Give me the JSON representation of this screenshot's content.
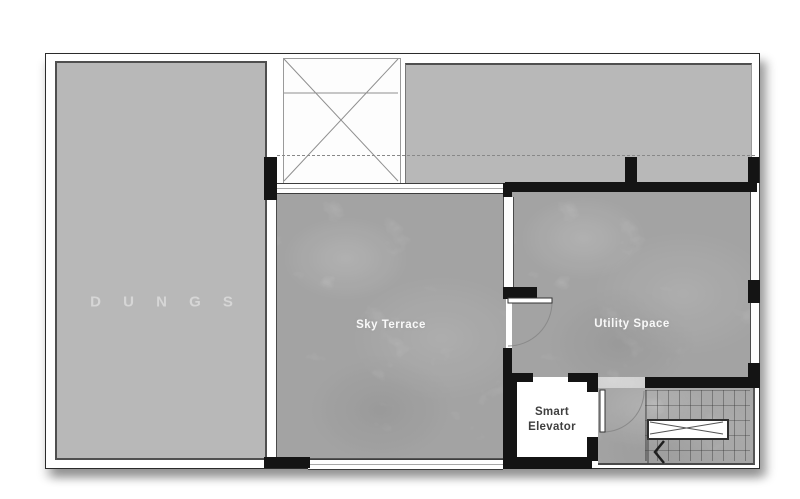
{
  "floor_plan": {
    "watermark": "D U N G S",
    "rooms": [
      {
        "id": "sky-terrace",
        "label": "Sky Terrace"
      },
      {
        "id": "utility-space",
        "label": "Utility Space"
      },
      {
        "id": "smart-elevator",
        "label": "Smart Elevator",
        "label_lines": [
          "Smart",
          "Elevator"
        ]
      }
    ],
    "features": [
      "roof-deck-left",
      "roof-deck-right",
      "skylight-shaft-x",
      "roof-overhang-dashed-line",
      "terrace-window-top",
      "terrace-window-bottom",
      "door-terrace-utility",
      "door-utility-stairs",
      "staircase-grid",
      "stair-landing-marker",
      "stair-direction-arrow"
    ],
    "colors": {
      "page_background": "#ffffff",
      "roof_deck_gray": "#b8b8b8",
      "room_concrete_gray": "#c6c6c6",
      "wall_black": "#141414",
      "outline_dark": "#2b2b2b",
      "room_label_white": "#f4f4f4",
      "elevator_text_gray": "#3f3f3f"
    }
  }
}
